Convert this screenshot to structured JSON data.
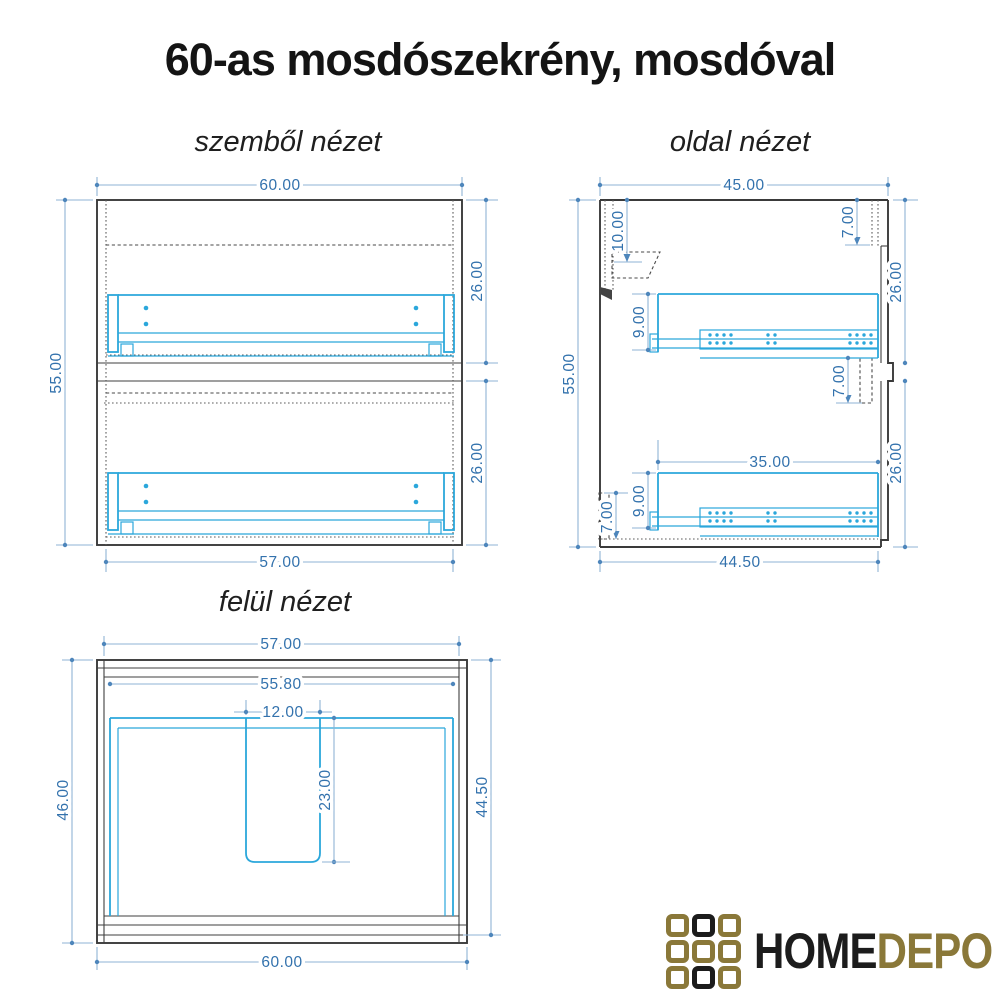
{
  "title": "60-as mosdószekrény, mosdóval",
  "views": {
    "front": {
      "label": "szemből nézet",
      "dims": {
        "w_top": "60.00",
        "h_left": "55.00",
        "sec_top": "26.00",
        "sec_bottom": "26.00",
        "w_bottom": "57.00"
      }
    },
    "side": {
      "label": "oldal nézet",
      "dims": {
        "d_top": "45.00",
        "h_left": "55.00",
        "inset_top_left": "10.00",
        "gap_top_right": "7.00",
        "sec_top": "26.00",
        "rail_top": "9.00",
        "gap_mid_right": "7.00",
        "drawer_len": "35.00",
        "rail_bottom": "9.00",
        "plinth_left": "7.00",
        "sec_bottom": "26.00",
        "d_bottom": "44.50"
      }
    },
    "top": {
      "label": "felül nézet",
      "dims": {
        "w_top": "57.00",
        "w_inner": "55.80",
        "cut_w": "12.00",
        "cut_d": "23.00",
        "d_left": "46.00",
        "d_right": "44.50",
        "w_bottom": "60.00"
      }
    }
  },
  "palette": {
    "outline": "#3a3a3a",
    "hardware_cyan": "#2ba7db",
    "dimension_blue": "#3372ad"
  },
  "logo": {
    "text_home": "HOME",
    "text_depo": "DEPO",
    "colors": {
      "gold": "#8a7839",
      "black": "#1c1c1c"
    },
    "grid": [
      [
        "gold",
        "black",
        "gold"
      ],
      [
        "gold",
        "gold",
        "gold"
      ],
      [
        "gold",
        "black",
        "gold"
      ]
    ]
  }
}
